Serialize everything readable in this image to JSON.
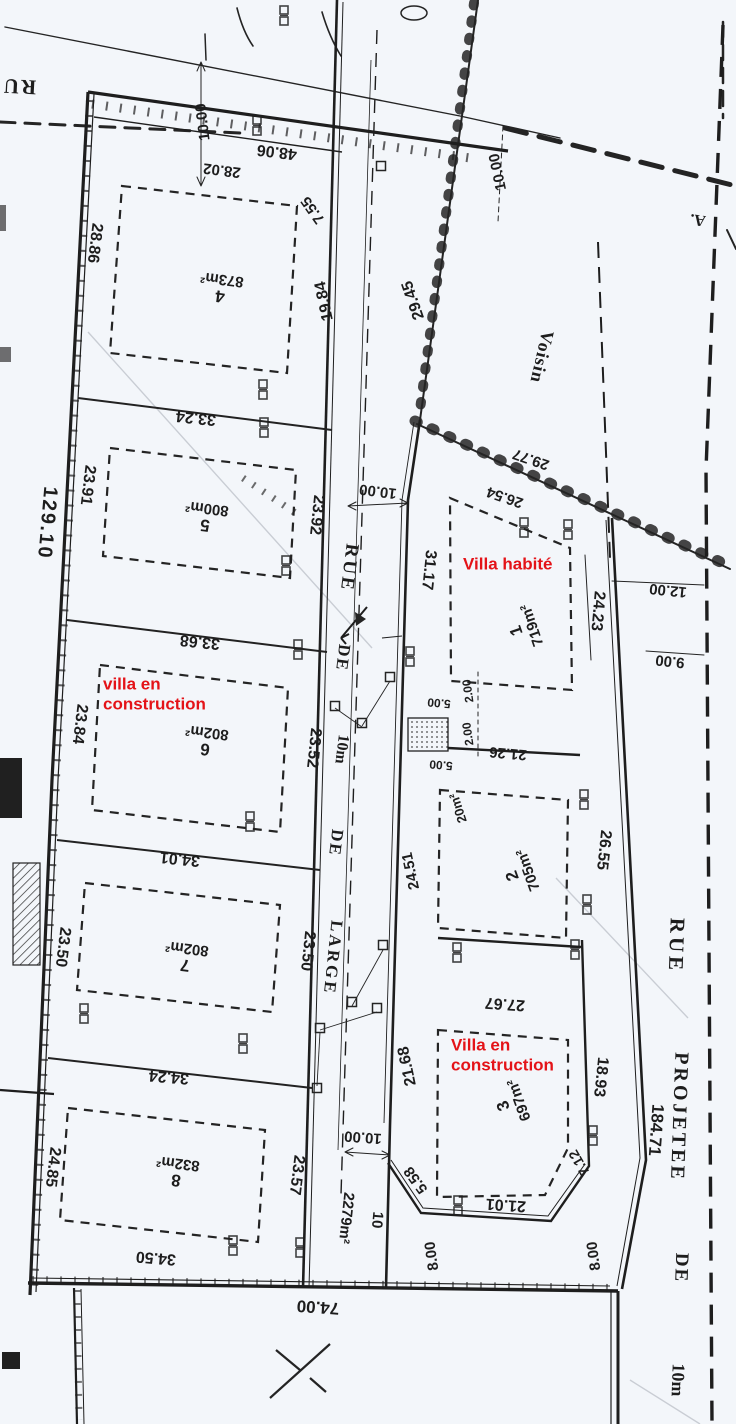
{
  "colors": {
    "ink": "#242424",
    "paper": "#f3f6fa",
    "red_annotation": "#e41318",
    "crease": "#c9cdd4"
  },
  "map": {
    "type": "cadastral subdivision plan (scanned)",
    "streets": {
      "central_road": {
        "name_parts": [
          "RUE",
          "DE",
          "10m",
          "DE",
          "LARGE"
        ],
        "width_dim": "10.00"
      },
      "projected_road": {
        "name_parts": [
          "RUE",
          "PROJETEE",
          "DE",
          "10m"
        ],
        "length": "184.71"
      },
      "top_left_street_partial": "RU"
    },
    "neighbor_label": "Voisin",
    "corner_reference": "A.",
    "red_annotations": [
      "Villa habité",
      "villa en construction",
      "Villa en construction"
    ],
    "parcels": [
      {
        "number": "1",
        "area": "719m²",
        "note": "Villa habité"
      },
      {
        "number": "2",
        "area": "705m²"
      },
      {
        "number": "3",
        "area": "697m²",
        "note": "Villa en construction"
      },
      {
        "number": "4",
        "area": "873m²"
      },
      {
        "number": "5",
        "area": "800m²"
      },
      {
        "number": "6",
        "area": "802m²",
        "note": "villa en construction"
      },
      {
        "number": "7",
        "area": "802m²"
      },
      {
        "number": "8",
        "area": "832m²"
      },
      {
        "number": "10",
        "area": "2279m²",
        "note": "road parcel"
      },
      {
        "number": "20m²",
        "area": "20m²",
        "note": "small utility structure"
      }
    ],
    "dimensions": [
      "48.06",
      "28.02",
      "7.55",
      "19.84",
      "10.00",
      "28.86",
      "23.91",
      "129.10",
      "23.84",
      "23.50",
      "24.85",
      "33.24",
      "33.68",
      "34.01",
      "34.24",
      "34.50",
      "74.00",
      "29.45",
      "23.92",
      "31.17",
      "26.54",
      "29.77",
      "24.23",
      "12.00",
      "9.00",
      "26.55",
      "18.93",
      "184.71",
      "21.26",
      "2.00",
      "5.00",
      "20m²",
      "24.51",
      "23.52",
      "27.67",
      "21.68",
      "23.57",
      "5.58",
      "8.00",
      "21.01",
      "7.12",
      "10",
      "2279m²"
    ]
  },
  "labels": [
    {
      "n": "street-label-central-rue",
      "t": "RUE",
      "x": 349,
      "y": 568,
      "r": 97,
      "s": 19,
      "f": "serif",
      "ls": 3
    },
    {
      "n": "street-label-central-de1",
      "t": "DE",
      "x": 343,
      "y": 658,
      "r": 97,
      "s": 17,
      "f": "serif",
      "ls": 2
    },
    {
      "n": "street-label-central-10m",
      "t": "10m",
      "x": 341,
      "y": 749,
      "r": 97,
      "s": 16,
      "f": "serif"
    },
    {
      "n": "street-label-central-de2",
      "t": "DE",
      "x": 336,
      "y": 843,
      "r": 97,
      "s": 17,
      "f": "serif",
      "ls": 2
    },
    {
      "n": "street-label-central-large",
      "t": "LARGE",
      "x": 333,
      "y": 958,
      "r": 96,
      "s": 17,
      "f": "serif",
      "ls": 3
    },
    {
      "n": "street-label-proj-rue",
      "t": "RUE",
      "x": 676,
      "y": 946,
      "r": 92,
      "s": 21,
      "f": "serif",
      "ls": 4
    },
    {
      "n": "street-label-proj-projetee",
      "t": "PROJETEE",
      "x": 679,
      "y": 1117,
      "r": 92,
      "s": 20,
      "f": "serif",
      "ls": 3
    },
    {
      "n": "street-label-proj-de",
      "t": "DE",
      "x": 681,
      "y": 1268,
      "r": 92,
      "s": 19,
      "f": "serif",
      "ls": 2
    },
    {
      "n": "street-label-proj-10m",
      "t": "10m",
      "x": 678,
      "y": 1380,
      "r": 92,
      "s": 18,
      "f": "serif"
    },
    {
      "n": "street-label-topleft",
      "t": "RU",
      "x": 19,
      "y": 86,
      "r": 183,
      "s": 21,
      "f": "serif",
      "ls": 2
    },
    {
      "n": "neighbor-label",
      "t": "Voisin",
      "x": 542,
      "y": 357,
      "r": 103,
      "s": 18,
      "f": "serif",
      "ls": 1
    },
    {
      "n": "corner-ref-label",
      "t": "A.",
      "x": 698,
      "y": 219,
      "r": 188,
      "s": 16,
      "f": "serif"
    },
    {
      "n": "dimension-label",
      "t": "48.06",
      "x": 277,
      "y": 151,
      "r": 187,
      "s": 16
    },
    {
      "n": "dimension-label",
      "t": "28.02",
      "x": 222,
      "y": 170,
      "r": 187,
      "s": 15
    },
    {
      "n": "dimension-label",
      "t": "7.55",
      "x": 313,
      "y": 210,
      "r": 235,
      "s": 15
    },
    {
      "n": "dimension-label",
      "t": "19.84",
      "x": 325,
      "y": 301,
      "r": 258,
      "s": 16
    },
    {
      "n": "dimension-label",
      "t": "10.00",
      "x": 203,
      "y": 122,
      "r": 263,
      "s": 15
    },
    {
      "n": "dimension-label",
      "t": "28.86",
      "x": 94,
      "y": 243,
      "r": 97,
      "s": 16
    },
    {
      "n": "dimension-label",
      "t": "23.91",
      "x": 87,
      "y": 485,
      "r": 97,
      "s": 16
    },
    {
      "n": "dimension-label",
      "t": "129.10",
      "x": 47,
      "y": 523,
      "r": 95,
      "s": 20,
      "ls": 2
    },
    {
      "n": "dimension-label",
      "t": "23.84",
      "x": 79,
      "y": 724,
      "r": 97,
      "s": 16
    },
    {
      "n": "dimension-label",
      "t": "23.50",
      "x": 62,
      "y": 947,
      "r": 97,
      "s": 16
    },
    {
      "n": "dimension-label",
      "t": "24.85",
      "x": 52,
      "y": 1167,
      "r": 97,
      "s": 16
    },
    {
      "n": "dimension-label",
      "t": "33.24",
      "x": 196,
      "y": 417,
      "r": 186,
      "s": 16
    },
    {
      "n": "dimension-label",
      "t": "33.68",
      "x": 200,
      "y": 641,
      "r": 186,
      "s": 16
    },
    {
      "n": "dimension-label",
      "t": "34.01",
      "x": 180,
      "y": 858,
      "r": 186,
      "s": 16
    },
    {
      "n": "dimension-label",
      "t": "34.24",
      "x": 169,
      "y": 1076,
      "r": 185,
      "s": 16
    },
    {
      "n": "dimension-label",
      "t": "34.50",
      "x": 156,
      "y": 1257,
      "r": 185,
      "s": 16
    },
    {
      "n": "dimension-label",
      "t": "74.00",
      "x": 318,
      "y": 1307,
      "r": 184,
      "s": 17
    },
    {
      "n": "dimension-label",
      "t": "29.45",
      "x": 414,
      "y": 300,
      "r": 251,
      "s": 16
    },
    {
      "n": "dimension-label",
      "t": "10.00",
      "x": 498,
      "y": 172,
      "r": 258,
      "s": 15
    },
    {
      "n": "dimension-label",
      "t": "10.00",
      "x": 378,
      "y": 491,
      "r": 187,
      "s": 15
    },
    {
      "n": "dimension-label",
      "t": "23.92",
      "x": 316,
      "y": 515,
      "r": 96,
      "s": 16
    },
    {
      "n": "dimension-label",
      "t": "31.17",
      "x": 428,
      "y": 570,
      "r": 96,
      "s": 16
    },
    {
      "n": "dimension-label",
      "t": "26.54",
      "x": 505,
      "y": 497,
      "r": 199,
      "s": 15
    },
    {
      "n": "dimension-label",
      "t": "29.77",
      "x": 531,
      "y": 459,
      "r": 199,
      "s": 15
    },
    {
      "n": "dimension-label",
      "t": "24.23",
      "x": 597,
      "y": 611,
      "r": 95,
      "s": 16
    },
    {
      "n": "dimension-label",
      "t": "12.00",
      "x": 668,
      "y": 590,
      "r": 186,
      "s": 15
    },
    {
      "n": "dimension-label",
      "t": "9.00",
      "x": 670,
      "y": 661,
      "r": 186,
      "s": 15
    },
    {
      "n": "dimension-label",
      "t": "26.55",
      "x": 603,
      "y": 850,
      "r": 96,
      "s": 16
    },
    {
      "n": "dimension-label",
      "t": "18.93",
      "x": 600,
      "y": 1077,
      "r": 96,
      "s": 16
    },
    {
      "n": "dimension-label",
      "t": "184.71",
      "x": 656,
      "y": 1130,
      "r": 94,
      "s": 17
    },
    {
      "n": "dimension-label",
      "t": "21.26",
      "x": 508,
      "y": 753,
      "r": 185,
      "s": 15
    },
    {
      "n": "dimension-label",
      "t": "2.00",
      "x": 468,
      "y": 691,
      "r": 262,
      "s": 12
    },
    {
      "n": "dimension-label",
      "t": "2.00",
      "x": 468,
      "y": 734,
      "r": 262,
      "s": 12
    },
    {
      "n": "dimension-label",
      "t": "5.00",
      "x": 439,
      "y": 703,
      "r": 185,
      "s": 12
    },
    {
      "n": "dimension-label",
      "t": "5.00",
      "x": 441,
      "y": 765,
      "r": 185,
      "s": 12
    },
    {
      "n": "dimension-label",
      "t": "20m²",
      "x": 458,
      "y": 808,
      "r": 252,
      "s": 13
    },
    {
      "n": "dimension-label",
      "t": "24.51",
      "x": 411,
      "y": 871,
      "r": 258,
      "s": 15
    },
    {
      "n": "dimension-label",
      "t": "23.52",
      "x": 313,
      "y": 748,
      "r": 96,
      "s": 16
    },
    {
      "n": "dimension-label",
      "t": "27.67",
      "x": 505,
      "y": 1003,
      "r": 184,
      "s": 16
    },
    {
      "n": "dimension-label",
      "t": "23.50",
      "x": 307,
      "y": 951,
      "r": 96,
      "s": 16
    },
    {
      "n": "dimension-label",
      "t": "21.68",
      "x": 408,
      "y": 1066,
      "r": 258,
      "s": 16
    },
    {
      "n": "dimension-label",
      "t": "23.57",
      "x": 296,
      "y": 1175,
      "r": 97,
      "s": 16
    },
    {
      "n": "dimension-label",
      "t": "10.00",
      "x": 363,
      "y": 1137,
      "r": 184,
      "s": 15
    },
    {
      "n": "dimension-label",
      "t": "5.58",
      "x": 416,
      "y": 1180,
      "r": 234,
      "s": 15
    },
    {
      "n": "dimension-label",
      "t": "8.00",
      "x": 432,
      "y": 1256,
      "r": 262,
      "s": 15
    },
    {
      "n": "dimension-label",
      "t": "8.00",
      "x": 594,
      "y": 1256,
      "r": 262,
      "s": 15
    },
    {
      "n": "dimension-label",
      "t": "21.01",
      "x": 506,
      "y": 1204,
      "r": 184,
      "s": 16
    },
    {
      "n": "dimension-label",
      "t": "7.12",
      "x": 579,
      "y": 1163,
      "r": 240,
      "s": 14
    },
    {
      "n": "parcel-number-label",
      "t": "10",
      "x": 377,
      "y": 1220,
      "r": 95,
      "s": 15
    },
    {
      "n": "parcel-area-label",
      "t": "2279m²",
      "x": 346,
      "y": 1218,
      "r": 96,
      "s": 15
    },
    {
      "n": "parcel-label",
      "lines": [
        "4",
        "873m²"
      ],
      "x": 221,
      "y": 288,
      "r": 187,
      "s": 17,
      "s2": 15
    },
    {
      "n": "parcel-label",
      "lines": [
        "5",
        "800m²"
      ],
      "x": 206,
      "y": 517,
      "r": 187,
      "s": 17,
      "s2": 15
    },
    {
      "n": "parcel-label",
      "lines": [
        "6",
        "802m²"
      ],
      "x": 206,
      "y": 741,
      "r": 187,
      "s": 17,
      "s2": 15
    },
    {
      "n": "parcel-label",
      "lines": [
        "7",
        "802m²"
      ],
      "x": 186,
      "y": 957,
      "r": 187,
      "s": 17,
      "s2": 15
    },
    {
      "n": "parcel-label",
      "lines": [
        "8",
        "832m²"
      ],
      "x": 177,
      "y": 1172,
      "r": 187,
      "s": 17,
      "s2": 15
    },
    {
      "n": "parcel-label",
      "lines": [
        "1",
        "719m²"
      ],
      "x": 524,
      "y": 628,
      "r": 251,
      "s": 17,
      "s2": 15
    },
    {
      "n": "parcel-label",
      "lines": [
        "2",
        "705m²"
      ],
      "x": 520,
      "y": 873,
      "r": 250,
      "s": 17,
      "s2": 15
    },
    {
      "n": "parcel-label",
      "lines": [
        "3",
        "697m²"
      ],
      "x": 511,
      "y": 1103,
      "r": 250,
      "s": 17,
      "s2": 15
    },
    {
      "n": "red-annotation",
      "t": "Villa habité",
      "x": 463,
      "y": 564,
      "r": 0,
      "s": 17,
      "c": "red",
      "a": "l"
    },
    {
      "n": "red-annotation",
      "t": "villa en",
      "x": 103,
      "y": 684,
      "r": 0,
      "s": 17,
      "c": "red",
      "a": "l"
    },
    {
      "n": "red-annotation",
      "t": "construction",
      "x": 103,
      "y": 704,
      "r": 0,
      "s": 17,
      "c": "red",
      "a": "l"
    },
    {
      "n": "red-annotation",
      "t": "Villa en",
      "x": 451,
      "y": 1045,
      "r": 0,
      "s": 17,
      "c": "red",
      "a": "l"
    },
    {
      "n": "red-annotation",
      "t": "construction",
      "x": 451,
      "y": 1065,
      "r": 0,
      "s": 17,
      "c": "red",
      "a": "l"
    }
  ]
}
